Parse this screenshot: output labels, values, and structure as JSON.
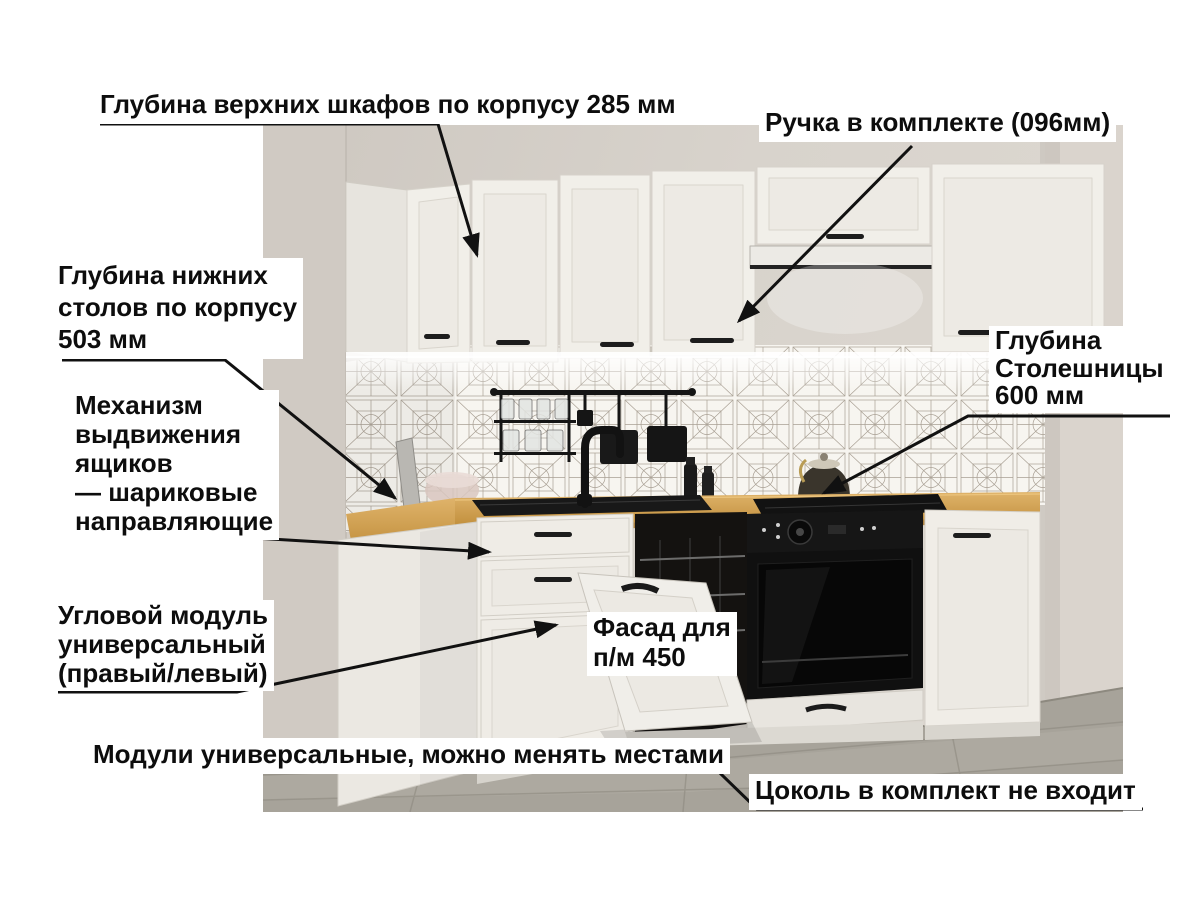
{
  "annotations": {
    "top_depth": {
      "text": "Глубина верхних шкафов по корпусу 285 мм"
    },
    "handle": {
      "text": "Ручка в комплекте (096мм)"
    },
    "lower_depth": {
      "text": "Глубина нижних\nстолов по корпусу\n503 мм"
    },
    "drawer_mechanism": {
      "text": "Механизм\nвыдвижения\nящиков\n— шариковые\nнаправляющие"
    },
    "countertop_depth": {
      "text": "Глубина\nСтолешницы\n600 мм"
    },
    "corner_module": {
      "text": "Угловой модуль\nуниверсальный\n(правый/левый)"
    },
    "dishwasher_facade": {
      "text": "Фасад для\nп/м 450"
    },
    "universal_modules": {
      "text": "Модули универсальные, можно менять местами"
    },
    "plinth": {
      "text": "Цоколь в комплект не входит"
    }
  },
  "colors": {
    "page_background": "#ffffff",
    "annotation_text": "#0d0d0d",
    "annotation_background": "#ffffff",
    "arrow": "#111111",
    "wall": "#d6d1ca",
    "tile_line": "#94897b",
    "cabinet_white": "#f0eee8",
    "countertop_wood": "#d0a055",
    "appliance_black": "#111111",
    "floor_gray": "#a7a39a",
    "led_glow": "#ffffff"
  }
}
